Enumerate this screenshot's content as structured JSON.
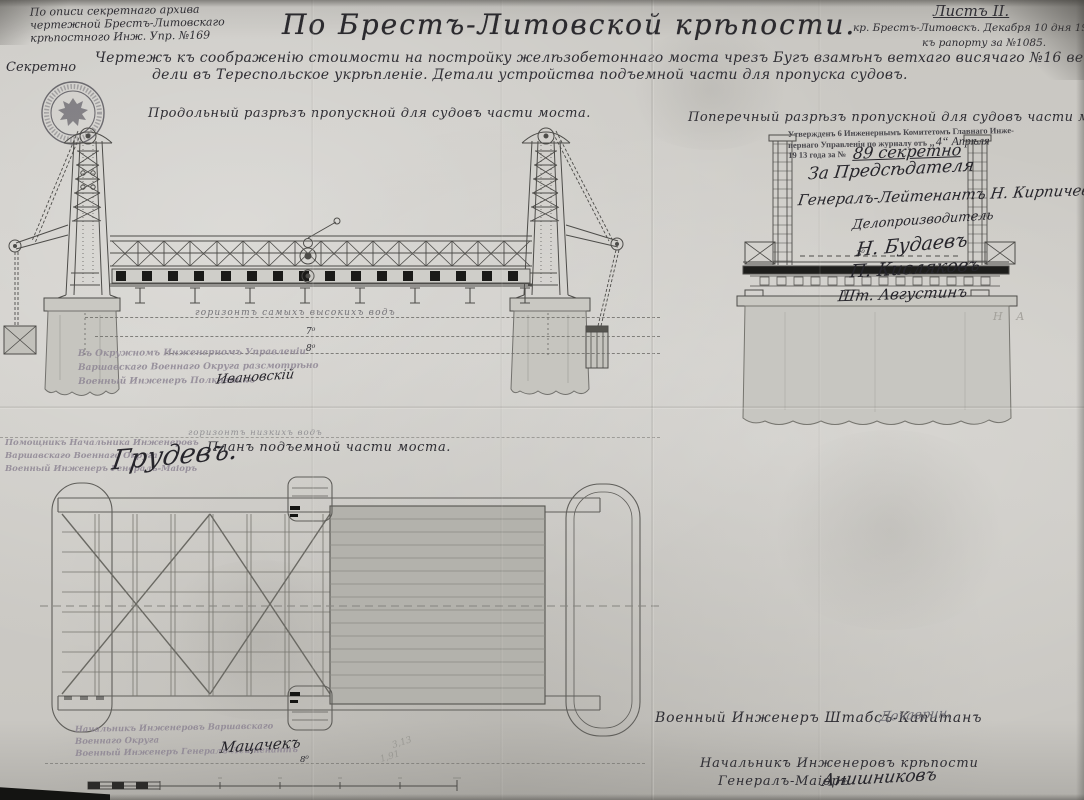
{
  "page": {
    "archive_note": [
      "По описи секретнаго архива",
      "чертежной Брестъ-Литовскаго",
      "крѣпостного Инж. Упр. №169"
    ],
    "title": "По Брестъ-Литовской крѣпости.",
    "sheet_label": "Листъ II.",
    "sheet_sub1": "кр. Брестъ-Литовскъ. Декабря 10 дня 1911 года",
    "sheet_sub2": "къ рапорту за №1085.",
    "secret": "Секретно",
    "subtitle_line1": "Чертежъ къ соображенію стоимости на постройку желѣзобетоннаго моста чрезъ Бугъ взамѣнъ ветхаго висячаго №16 ведущаго изъ цита-",
    "subtitle_line2": "дели въ Тереспольское укрѣпленіе. Детали устройства подъемной части для пропуска судовъ."
  },
  "sections": {
    "longitudinal_label": "Продольный разрѣзъ пропускной для судовъ части моста.",
    "cross_label": "Поперечный разрѣзъ пропускной для судовъ части моста.",
    "plan_label": "Планъ подъемной части моста."
  },
  "water": {
    "high_water": "горизонтъ самыхъ высокихъ водъ",
    "low_water": "горизонтъ низкихъ водъ",
    "mark_7": "7⁰",
    "mark_8": "8⁰",
    "mark_3": "3⁰",
    "mark_8_plan": "8⁰"
  },
  "approval_stamp": {
    "line1": "Утвержденъ 6 Инженернымъ Комитетомъ Главнаго Инже-",
    "line2": "нернаго Управленія по журналу отъ",
    "line2_hw": "„4“ Апрѣля",
    "line3": "19 13 года за №",
    "number_hw": "89 секретно"
  },
  "signatures_right": [
    "За Предсѣдателя",
    "Генералъ-Лейтенантъ Н. Кирпичевъ",
    "Делопроизводитель",
    "Н. Будаевъ",
    "П. Кисляковъ",
    "Шт. Августинъ"
  ],
  "stamp_okr": {
    "lines": [
      "Въ Окружномъ Инженерномъ Управленіи",
      "Варшавскаго Военнаго Округа разсмотрѣно",
      "Военный Инженеръ Полковникъ"
    ],
    "signature": "Ивановскій"
  },
  "stamp_pom": {
    "lines": [
      "Помощникъ Начальника Инженеровъ",
      "Варшавскаго Военнаго Округа",
      "Военный Инженеръ Генералъ-Маіоръ"
    ],
    "signature": "Грудевъ."
  },
  "stamp_nach": {
    "lines": [
      "Начальникъ Инженеровъ Варшавскаго",
      "Военнаго Округа",
      "Военный Инженеръ Генералъ-Лейтенантъ"
    ],
    "signature": "Мацачекъ"
  },
  "bottom_right": {
    "line1": "Военный Инженеръ Штабсъ-Капитанъ",
    "sig1": "Дочаврин.",
    "line2": "Начальникъ Инженеровъ крѣпости",
    "line3": "Генералъ-Маіоръ",
    "sig2": "Анишниковъ"
  },
  "pencil": {
    "n1": "3,13",
    "n2": "1,91",
    "corner": "Н А"
  },
  "colors": {
    "paper": "#cbc9c4",
    "ink": "#4b4a48",
    "faded_stamp": "#8e8694",
    "deck_black": "#1a1a18"
  }
}
